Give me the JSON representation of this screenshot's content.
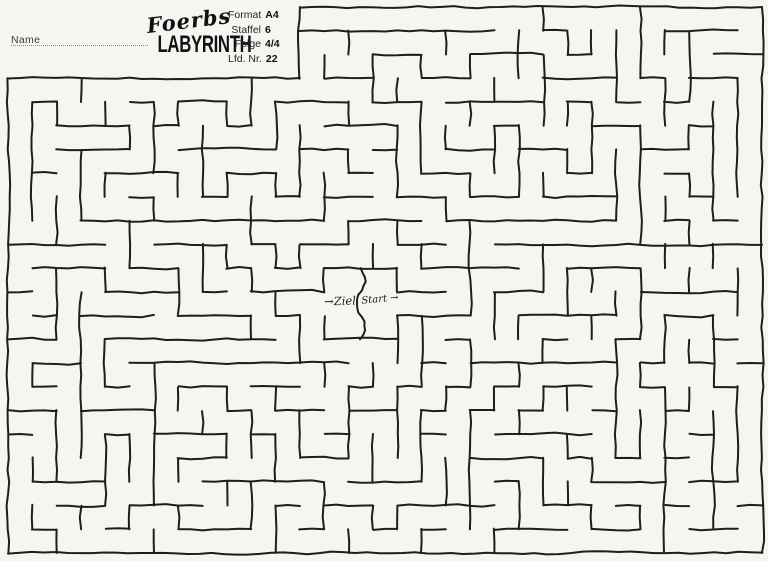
{
  "page": {
    "background": "#f5f5f2",
    "ink": "#1e1e1e"
  },
  "header": {
    "name_label": "Name",
    "logo": {
      "script": "Foerbs",
      "title": "LABYRINTH"
    },
    "info": {
      "rows": [
        {
          "label": "Format",
          "value": "A4"
        },
        {
          "label": "Staffel",
          "value": "6"
        },
        {
          "label": "Folge",
          "value": "4/4"
        },
        {
          "label": "Lfd. Nr.",
          "value": "22"
        }
      ]
    }
  },
  "maze": {
    "ziel_label": "→Ziel",
    "start_label": "Start →",
    "stroke": "#1e1e1e",
    "stroke_width": 2,
    "seed": 1337,
    "grid": {
      "cols": 31,
      "rows": 23,
      "x0": 8,
      "y0": 7,
      "x1": 762,
      "y1": 553
    },
    "notch": {
      "cols": 12,
      "rows": 3
    },
    "room": {
      "col0": 13,
      "col1": 15,
      "row0": 11,
      "row1": 13
    },
    "gap_row": 12
  }
}
